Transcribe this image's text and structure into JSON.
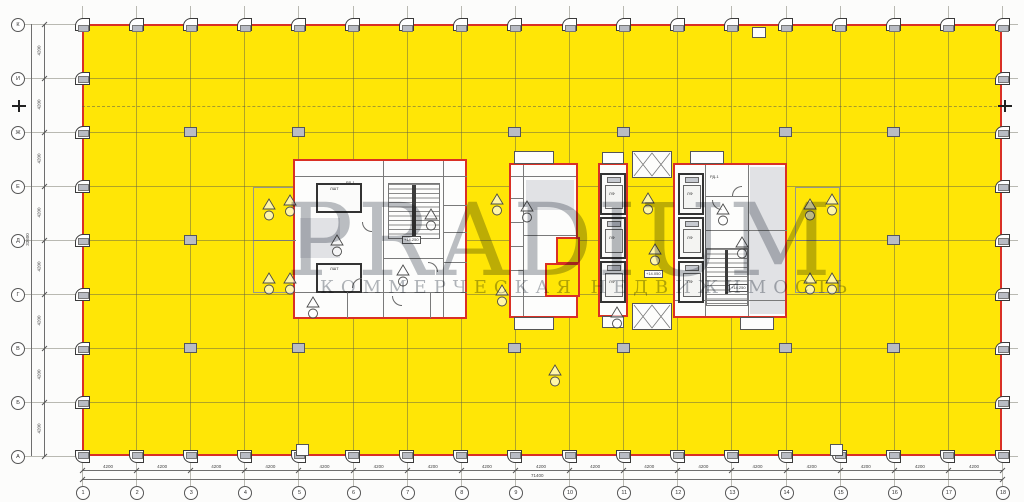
{
  "watermark": {
    "title": "PRADIUM",
    "subtitle": "КОММЕРЧЕСКАЯ НЕДВИЖИМОСТЬ"
  },
  "axes": {
    "bottom_labels": [
      "1",
      "2",
      "3",
      "4",
      "5",
      "6",
      "7",
      "8",
      "9",
      "10",
      "11",
      "12",
      "13",
      "14",
      "15",
      "16",
      "17",
      "18"
    ],
    "left_labels": [
      "К",
      "И",
      "Ж",
      "Е",
      "Д",
      "Г",
      "В",
      "Б",
      "А"
    ],
    "bay_dim": "4200",
    "total_bottom": "71400",
    "total_left": "33600"
  },
  "core_labels": {
    "lift_shaft": "ЛШТ",
    "lift": "ЛФ",
    "door_tag": "РД-1",
    "level_stair": "+14.250",
    "level_corridor": "+14.050"
  },
  "colors": {
    "highlight_yellow": "#ffe606",
    "outline_red": "#d93025",
    "column_gray": "#b9bcc4",
    "watermark_gray": "#798089"
  }
}
